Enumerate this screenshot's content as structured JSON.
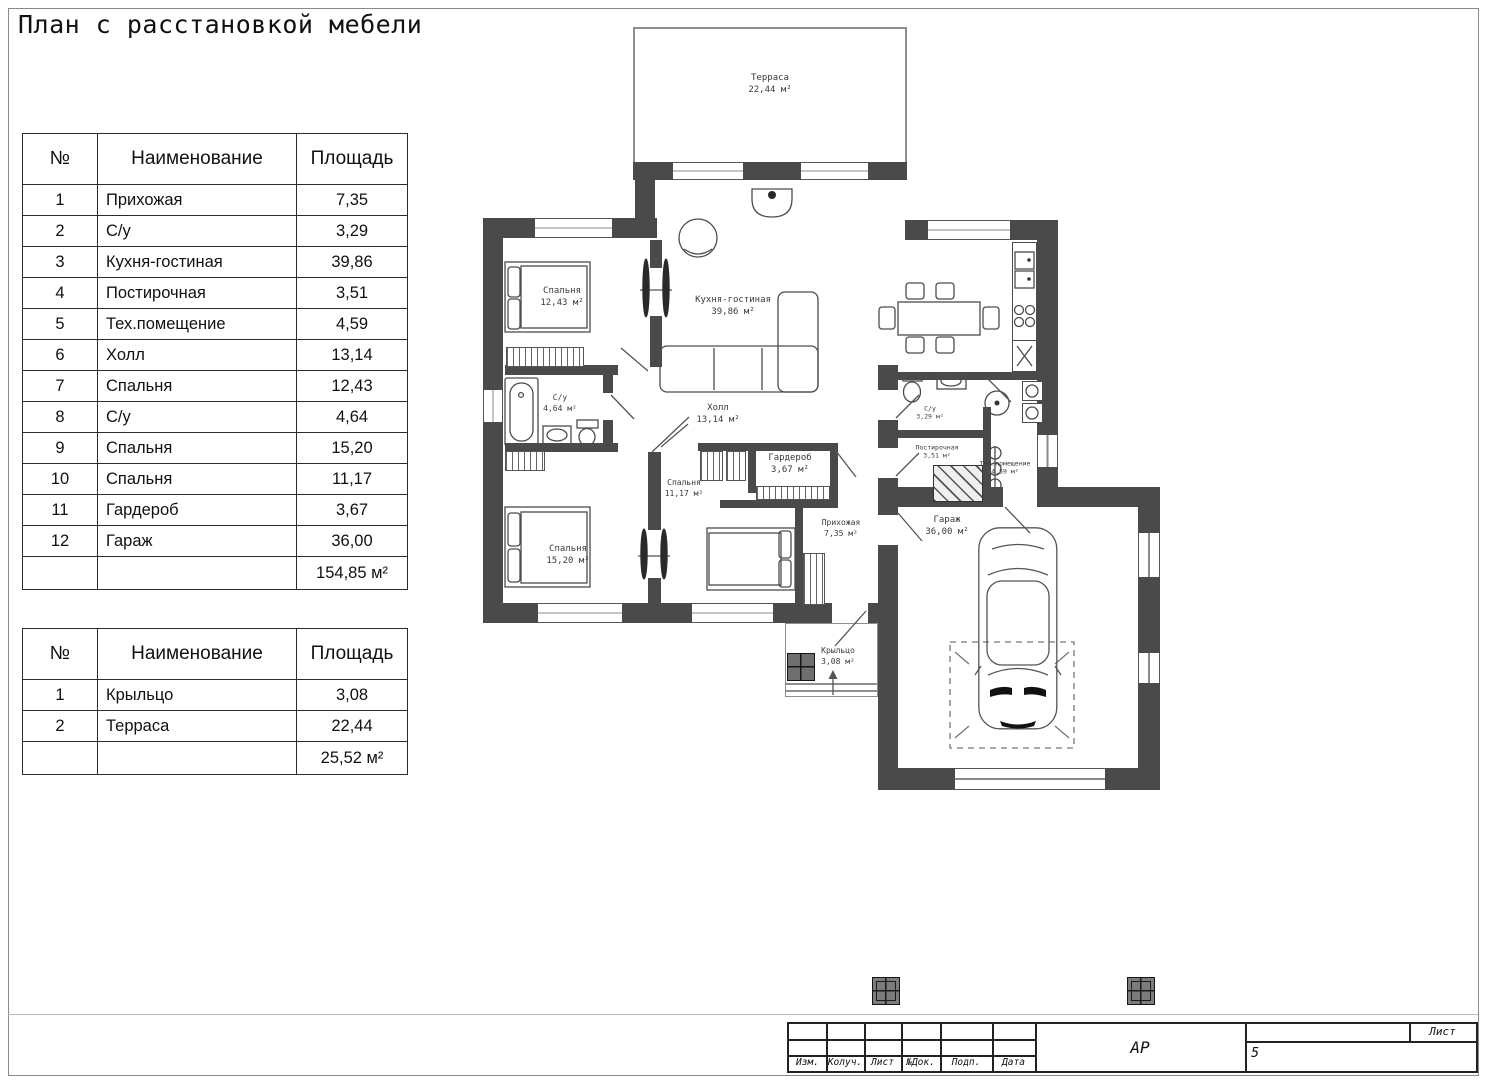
{
  "page": {
    "title": "План с расстановкой мебели"
  },
  "tables": {
    "headers": {
      "num": "№",
      "name": "Наименование",
      "area": "Площадь"
    },
    "rooms": {
      "rows": [
        [
          "1",
          "Прихожая",
          "7,35"
        ],
        [
          "2",
          "С/у",
          "3,29"
        ],
        [
          "3",
          "Кухня-гостиная",
          "39,86"
        ],
        [
          "4",
          "Постирочная",
          "3,51"
        ],
        [
          "5",
          "Тех.помещение",
          "4,59"
        ],
        [
          "6",
          "Холл",
          "13,14"
        ],
        [
          "7",
          "Спальня",
          "12,43"
        ],
        [
          "8",
          "С/у",
          "4,64"
        ],
        [
          "9",
          "Спальня",
          "15,20"
        ],
        [
          "10",
          "Спальня",
          "11,17"
        ],
        [
          "11",
          "Гардероб",
          "3,67"
        ],
        [
          "12",
          "Гараж",
          "36,00"
        ]
      ],
      "total": "154,85 м²"
    },
    "outdoor": {
      "rows": [
        [
          "1",
          "Крыльцо",
          "3,08"
        ],
        [
          "2",
          "Терраса",
          "22,44"
        ]
      ],
      "total": "25,52 м²"
    }
  },
  "plan": {
    "terrace": {
      "name": "Терраса",
      "area": "22,44 м²"
    },
    "bedroom1": {
      "name": "Спальня",
      "area": "12,43 м²"
    },
    "kitchen": {
      "name": "Кухня-гостиная",
      "area": "39,86 м²"
    },
    "bath1": {
      "name": "С/у",
      "area": "4,64 м²"
    },
    "hall": {
      "name": "Холл",
      "area": "13,14 м²"
    },
    "bedroom2": {
      "name": "Спальня",
      "area": "11,17 м²"
    },
    "wardrobe": {
      "name": "Гардероб",
      "area": "3,67 м²"
    },
    "bedroom3": {
      "name": "Спальня",
      "area": "15,20 м²"
    },
    "entry": {
      "name": "Прихожая",
      "area": "7,35 м²"
    },
    "bath2": {
      "name": "С/у",
      "area": "3,29 м²"
    },
    "laundry": {
      "name": "Постирочная",
      "area": "3,51 м²"
    },
    "tech": {
      "name": "Тех.помещение",
      "area": "4,59 м²"
    },
    "garage": {
      "name": "Гараж",
      "area": "36,00 м²"
    },
    "porch": {
      "name": "Крыльцо",
      "area": "3,08 м²"
    }
  },
  "titleblock": {
    "cols": [
      "Изм.",
      "Колуч.",
      "Лист",
      "№Док.",
      "Подп.",
      "Дата"
    ],
    "code": "АР",
    "sheet_label": "Лист",
    "sheet_number": "5",
    "colors": {
      "wall": "#4a4a4a",
      "line": "#4c4c4c"
    }
  }
}
